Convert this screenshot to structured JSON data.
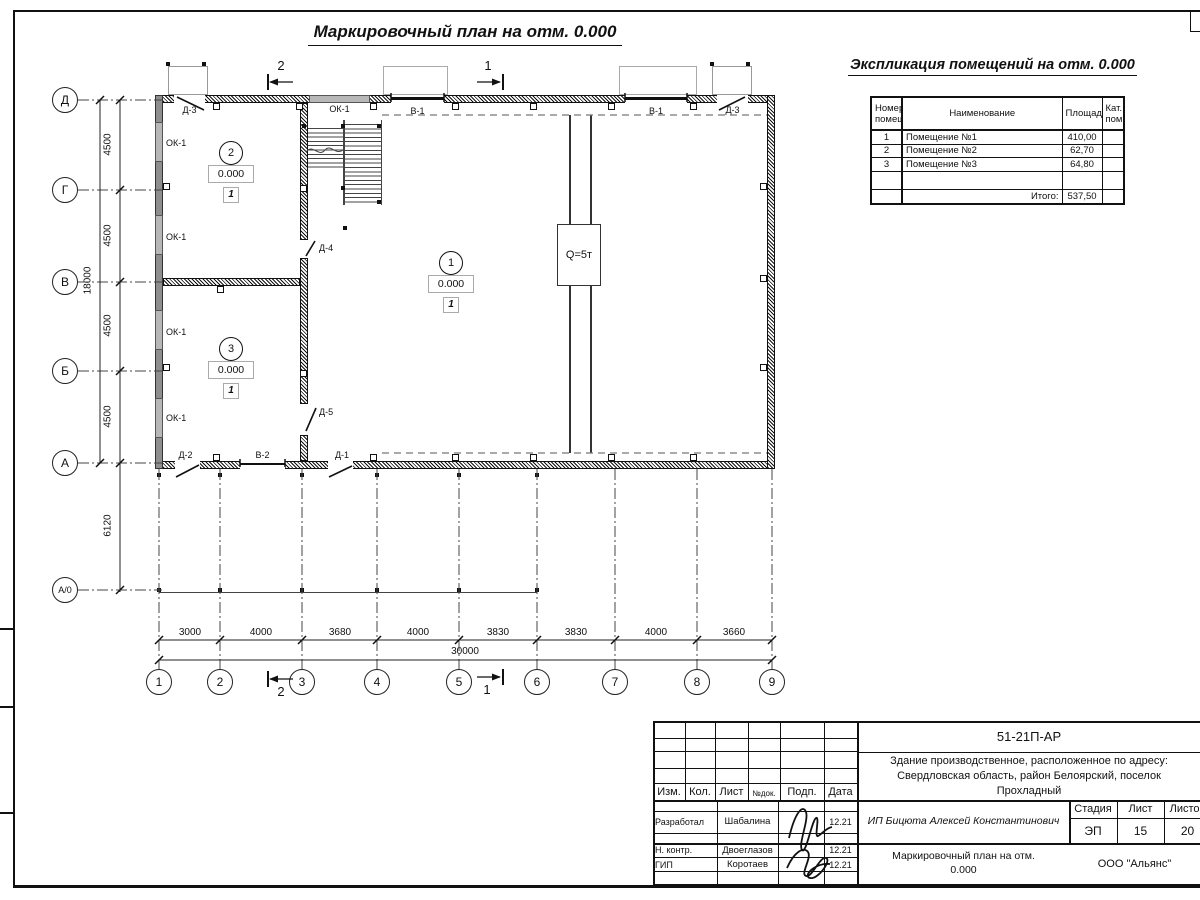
{
  "page": {
    "title": "Маркировочный план на отм. 0.000"
  },
  "explication": {
    "title": "Экспликация помещений на отм. 0.000",
    "columns": [
      "Номер помещ.",
      "Наименование",
      "Площадь",
      "Кат. пом."
    ],
    "rows": [
      {
        "num": "1",
        "name": "Помещение №1",
        "area": "410,00",
        "cat": ""
      },
      {
        "num": "2",
        "name": "Помещение №2",
        "area": "62,70",
        "cat": ""
      },
      {
        "num": "3",
        "name": "Помещение №3",
        "area": "64,80",
        "cat": ""
      }
    ],
    "total_label": "Итого:",
    "total_value": "537,50"
  },
  "plan": {
    "crane_label": "Q=5т",
    "openings": {
      "window": "ОК-1",
      "gate1": "В-1",
      "gate2": "В-2",
      "door1": "Д-1",
      "door2": "Д-2",
      "door3": "Д-3",
      "door4": "Д-4",
      "door5": "Д-5"
    },
    "rooms": [
      {
        "number": "1",
        "elevation": "0.000",
        "category": "1"
      },
      {
        "number": "2",
        "elevation": "0.000",
        "category": "1"
      },
      {
        "number": "3",
        "elevation": "0.000",
        "category": "1"
      }
    ]
  },
  "axes": {
    "rows": [
      "Д",
      "Г",
      "В",
      "Б",
      "А",
      "А/0"
    ],
    "cols": [
      "1",
      "2",
      "3",
      "4",
      "5",
      "6",
      "7",
      "8",
      "9"
    ]
  },
  "dimensions": {
    "left": [
      "4500",
      "4500",
      "4500",
      "4500"
    ],
    "left_lower": "6120",
    "left_total": "18000",
    "bottom": [
      "3000",
      "4000",
      "3680",
      "4000",
      "3830",
      "3830",
      "4000",
      "3660"
    ],
    "bottom_total": "30000"
  },
  "sections": {
    "mark1": "1",
    "mark2": "2"
  },
  "titleblock": {
    "code": "51-21П-АР",
    "address_line1": "Здание производственное, расположенное по адресу:",
    "address_line2": "Свердловская область, район Белоярский, поселок",
    "address_line3": "Прохладный",
    "client": "ИП Бицюта Алексей Константинович",
    "sheet_title_line1": "Маркировочный план на отм.",
    "sheet_title_line2": "0.000",
    "company": "ООО \"Альянс\"",
    "stage_label": "Стадия",
    "sheet_label": "Лист",
    "sheets_label": "Листов",
    "stage": "ЭП",
    "sheet": "15",
    "sheets": "20",
    "cols": {
      "izm": "Изм.",
      "kol": "Кол.",
      "list": "Лист",
      "doc": "№док.",
      "podp": "Подп.",
      "data": "Дата"
    },
    "roles": [
      {
        "role": "Разработал",
        "name": "Шабалина",
        "date": "12.21"
      },
      {
        "role": "Н. контр.",
        "name": "Двоеглазов",
        "date": "12.21"
      },
      {
        "role": "ГИП",
        "name": "Коротаев",
        "date": "12.21"
      }
    ]
  }
}
